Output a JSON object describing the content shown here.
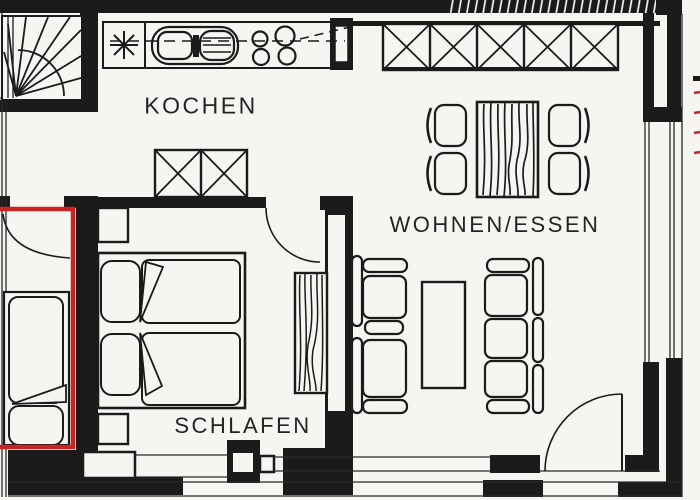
{
  "plan": {
    "title": "apartment floor plan (scanned architectural drawing)",
    "rooms": [
      {
        "id": "kochen",
        "label": "KOCHEN"
      },
      {
        "id": "wohnen_essen",
        "label": "WOHNEN/ESSEN"
      },
      {
        "id": "schlafen",
        "label": "SCHLAFEN"
      }
    ],
    "symbols": [
      "staircase-icon",
      "kitchen-counter-icon",
      "star-appliance-icon",
      "double-sink-icon",
      "stove-burners-icon",
      "cabinet-x-icon",
      "wardrobe-x-icon",
      "dining-table-icon",
      "chair-icon",
      "double-bed-icon",
      "single-bed-icon",
      "nightstand-icon",
      "wardrobe-woodgrain-icon",
      "sofa-2seat-icon",
      "sofa-3seat-icon",
      "coffee-table-icon",
      "door-swing-icon",
      "window-icon"
    ],
    "colors": {
      "highlight": "#c92323",
      "ink": "#1b1b1b",
      "paper": "#f6f5f1"
    }
  }
}
